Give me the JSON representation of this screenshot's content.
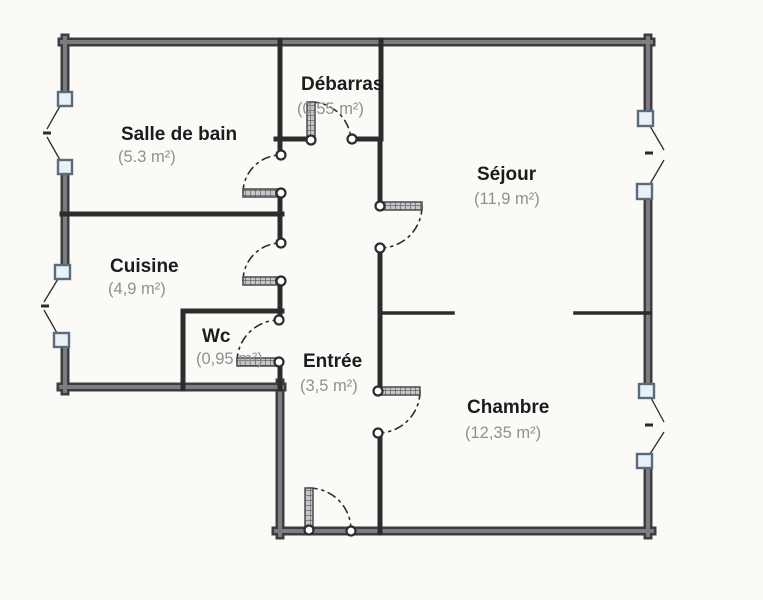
{
  "document": {
    "type": "apartment floor plan (scanned)"
  },
  "rooms": [
    {
      "id": "salle-de-bain",
      "name": "Salle de bain",
      "area": "(5.3 m²)"
    },
    {
      "id": "debarras",
      "name": "Débarras",
      "area": "(0,55 m²)"
    },
    {
      "id": "sejour",
      "name": "Séjour",
      "area": "(11,9 m²)"
    },
    {
      "id": "cuisine",
      "name": "Cuisine",
      "area": "(4,9 m²)"
    },
    {
      "id": "wc",
      "name": "Wc",
      "area": "(0,95 m²)"
    },
    {
      "id": "entree",
      "name": "Entrée",
      "area": "(3,5 m²)"
    },
    {
      "id": "chambre",
      "name": "Chambre",
      "area": "(12,35 m²)"
    }
  ],
  "symbols": {
    "door_count": 7,
    "window_count": 4,
    "door_symbol": "hatched leaf with dashed quarter-circle swing arc and white hinge/jamb nodes",
    "window_symbol": "two pale squares on wall with thin outward V opening lines"
  },
  "colors": {
    "paper": "#fbfaf7",
    "wallDark": "#3d3d40",
    "wallCore": "#7d7d81",
    "wallInt": "#2c2c2e",
    "windowFill": "#e9f1f8",
    "windowStroke": "#5a6c7c",
    "textDark": "#1c1c1e",
    "textGray": "#909092"
  }
}
